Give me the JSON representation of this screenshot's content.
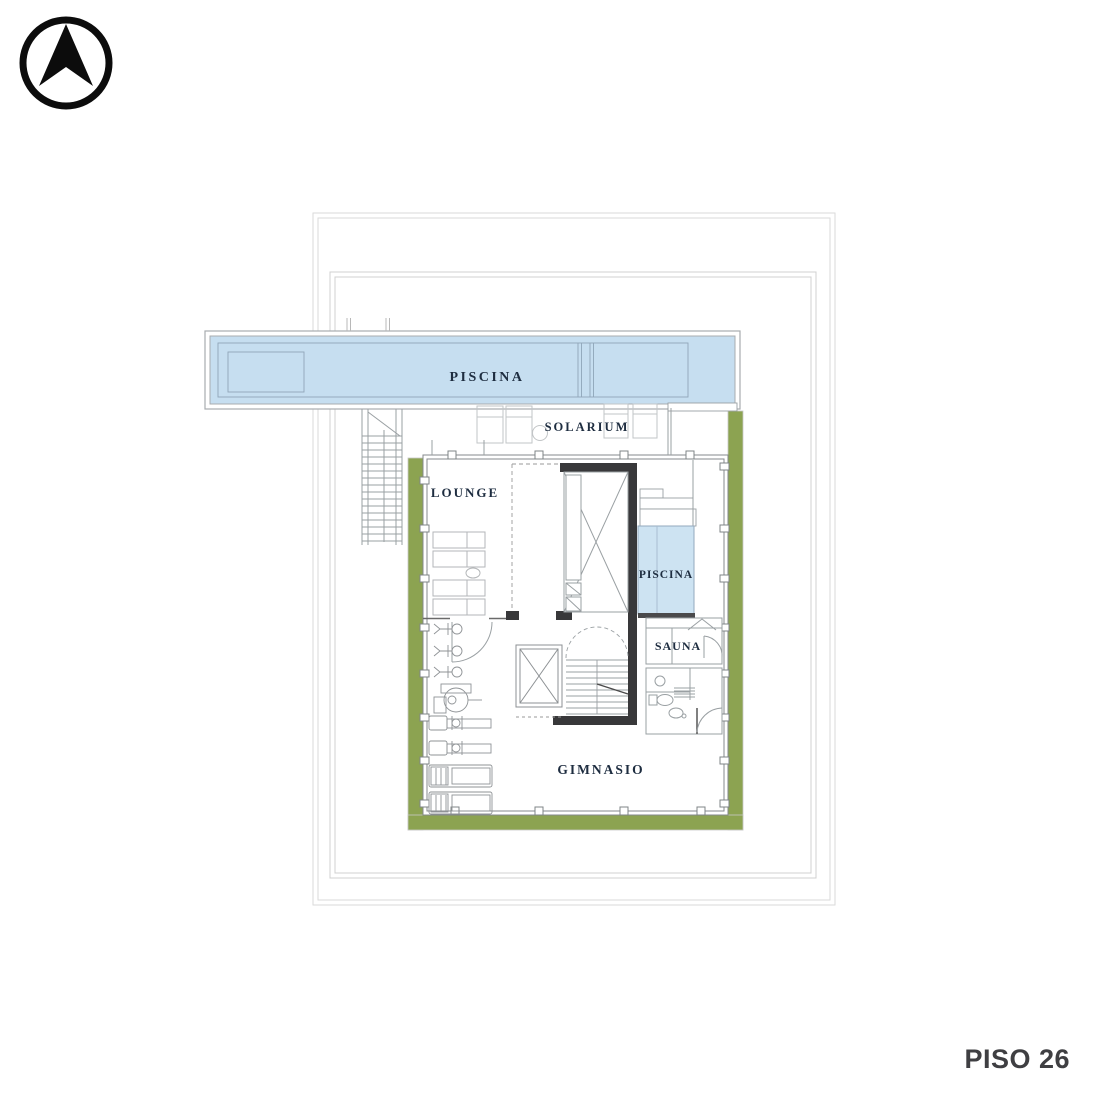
{
  "floor_label": "PISO 26",
  "logo": {
    "icon": "north-arrow-compass"
  },
  "rooms": {
    "pool_main": "PISCINA",
    "solarium": "SOLARIUM",
    "lounge": "LOUNGE",
    "pool_indoor": "PISCINA",
    "sauna": "SAUNA",
    "gym": "GIMNASIO"
  },
  "colors": {
    "water": "#c6def0",
    "water_indoor": "#cde3f2",
    "planter": "#8ca351",
    "wall_dark": "#38383a",
    "label": "#1e2d40"
  }
}
